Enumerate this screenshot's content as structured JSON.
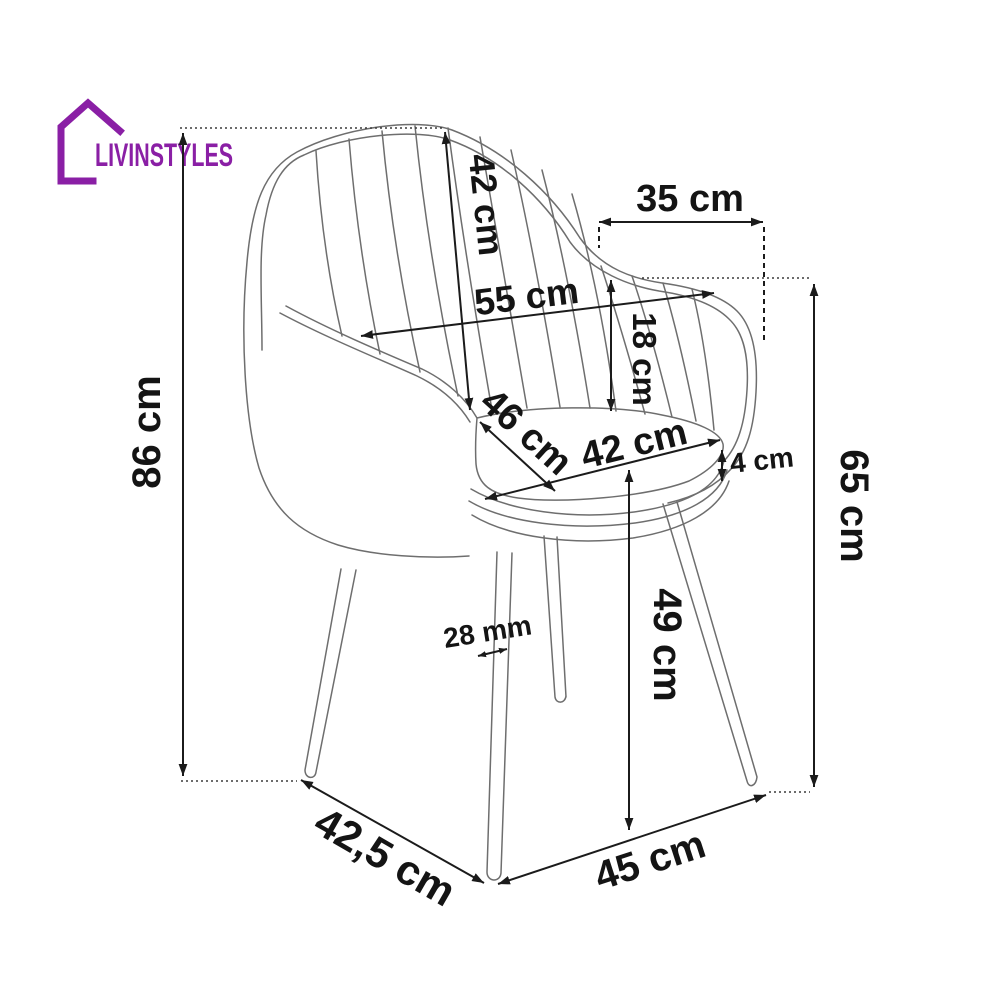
{
  "brand": {
    "name": "LIVINSTYLES",
    "color": "#8a1fa5"
  },
  "diagram": {
    "dimensions": {
      "total_height": "86 cm",
      "backrest_height": "42 cm",
      "armrest_span_top": "35 cm",
      "overall_width": "55 cm",
      "backrest_above_seat": "18 cm",
      "seat_depth": "46 cm",
      "seat_width": "42 cm",
      "cushion_thickness": "4 cm",
      "armrest_height": "65 cm",
      "seat_height": "49 cm",
      "leg_thickness": "28 mm",
      "base_depth": "42,5 cm",
      "front_width": "45 cm"
    },
    "colors": {
      "chair_line": "#6e6e6e",
      "dimension_line": "#1b1b1b",
      "background": "#ffffff"
    }
  }
}
